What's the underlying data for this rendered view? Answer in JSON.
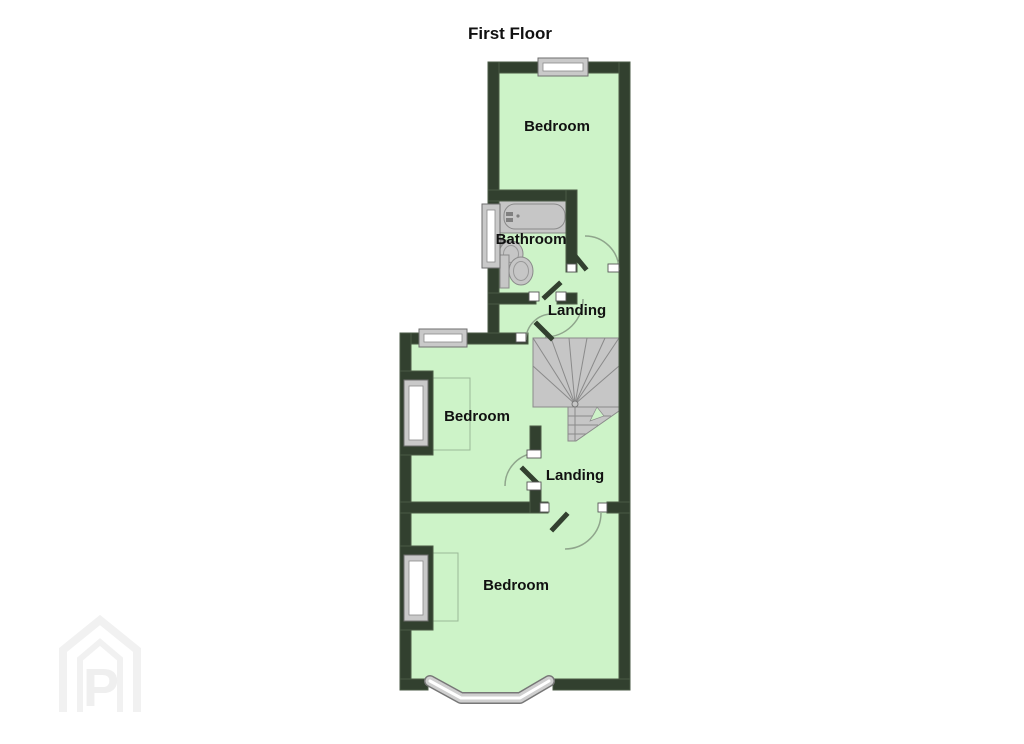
{
  "title": "First Floor",
  "rooms": [
    {
      "id": "bedroom-top",
      "label": "Bedroom"
    },
    {
      "id": "bathroom",
      "label": "Bathroom"
    },
    {
      "id": "landing-upper",
      "label": "Landing"
    },
    {
      "id": "bedroom-middle",
      "label": "Bedroom"
    },
    {
      "id": "landing-lower",
      "label": "Landing"
    },
    {
      "id": "bedroom-bottom",
      "label": "Bedroom"
    }
  ],
  "fixtures": [
    "bathtub",
    "sink",
    "toilet",
    "staircase",
    "bay-window",
    "windows",
    "door-swings"
  ],
  "watermark": {
    "letter": "P"
  },
  "colors": {
    "wall": "#32402f",
    "room_fill": "#cdf3c8",
    "fixture_gray": "#c6c6c6",
    "window_pane": "#ffffff",
    "background": "#ffffff"
  }
}
